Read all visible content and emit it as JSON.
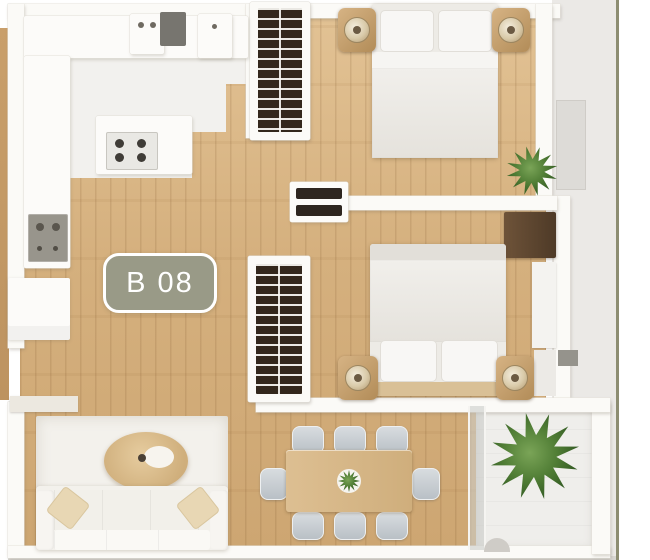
{
  "unit_badge": {
    "label": "B 08"
  },
  "palette": {
    "badge_fill": "#999a87",
    "badge_border": "#ffffff",
    "badge_text": "#ffffff",
    "wood_floor": "#d5b07e",
    "wall": "#fbfaf7",
    "kitchen_floor": "#f2f1ee",
    "exterior_backdrop": "#ebe9e6",
    "wardrobe_interior": "#33271c",
    "plant_green": "#507d35",
    "area_rug": "#f3f1ec",
    "dining_wood": "#d5b384",
    "chair_gray": "#c3c9ce",
    "page_rule": "#8d8d72"
  },
  "inventory": {
    "bedrooms": 2,
    "double_beds": 2,
    "wardrobes": 2,
    "nightstands": 4,
    "table_lamps": 4,
    "sofas": 1,
    "coffee_tables": 1,
    "dining_tables": 1,
    "dining_chairs": 8,
    "plants": 3,
    "cooktop_burners": 4,
    "balconies": 1
  }
}
